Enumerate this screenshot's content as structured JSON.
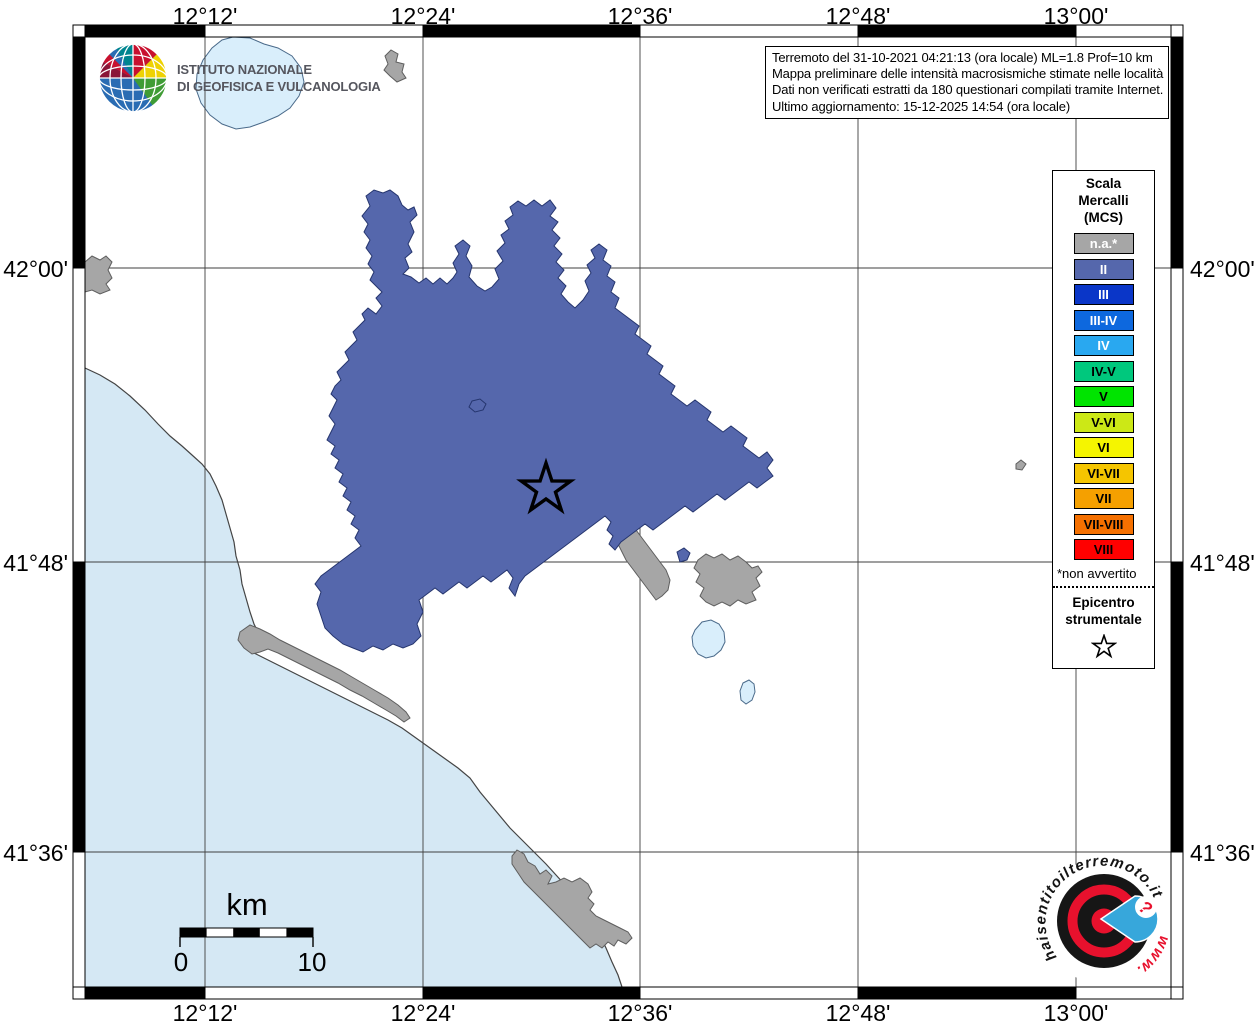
{
  "branding": {
    "org_line1": "ISTITUTO NAZIONALE",
    "org_line2": "DI GEOFISICA E VULCANOLOGIA"
  },
  "info_box": {
    "lines": [
      "Terremoto del 31-10-2021 04:21:13 (ora locale) ML=1.8 Prof=10 km",
      "Mappa preliminare delle intensità macrosismiche stimate nelle località",
      "Dati non verificati estratti da 180 questionari compilati tramite Internet.",
      "Ultimo aggiornamento: 15-12-2025 14:54 (ora locale)"
    ]
  },
  "legend": {
    "title_lines": [
      "Scala",
      "Mercalli",
      "(MCS)"
    ],
    "items": [
      {
        "label": "n.a.*",
        "color": "#A6A6A6",
        "text_color": "#FFFFFF"
      },
      {
        "label": "II",
        "color": "#5567AC",
        "text_color": "#FFFFFF"
      },
      {
        "label": "III",
        "color": "#0A36C8",
        "text_color": "#FFFFFF"
      },
      {
        "label": "III-IV",
        "color": "#0D68DE",
        "text_color": "#FFFFFF"
      },
      {
        "label": "IV",
        "color": "#29A8F0",
        "text_color": "#FFFFFF"
      },
      {
        "label": "IV-V",
        "color": "#00C87D",
        "text_color": "#000000"
      },
      {
        "label": "V",
        "color": "#00E400",
        "text_color": "#000000"
      },
      {
        "label": "V-VI",
        "color": "#CCE816",
        "text_color": "#000000"
      },
      {
        "label": "VI",
        "color": "#F5F500",
        "text_color": "#000000"
      },
      {
        "label": "VI-VII",
        "color": "#F5C500",
        "text_color": "#000000"
      },
      {
        "label": "VII",
        "color": "#F5A000",
        "text_color": "#000000"
      },
      {
        "label": "VII-VIII",
        "color": "#F57000",
        "text_color": "#000000"
      },
      {
        "label": "VIII",
        "color": "#FF0000",
        "text_color": "#000000"
      }
    ],
    "footnote": "*non avvertito",
    "epicenter_lines": [
      "Epicentro",
      "strumentale"
    ]
  },
  "axes": {
    "top": [
      "12°12'",
      "12°24'",
      "12°36'",
      "12°48'",
      "13°00'"
    ],
    "bottom": [
      "12°12'",
      "12°24'",
      "12°36'",
      "12°48'",
      "13°00'"
    ],
    "left": [
      "42°00'",
      "41°48'",
      "41°36'"
    ],
    "right": [
      "42°00'",
      "41°48'",
      "41°36'"
    ]
  },
  "scale_bar": {
    "unit": "km",
    "start_label": "0",
    "end_label": "10"
  },
  "watermark": {
    "site_text": "haisentitoilterremoto.it",
    "www_text": "www.",
    "question_mark": "?"
  },
  "map": {
    "colors": {
      "sea": "#D5E8F4",
      "lake": "#D9EEFB",
      "land": "#FFFFFF",
      "intensity_ii": "#5567AC",
      "intensity_na": "#A6A6A6"
    }
  }
}
